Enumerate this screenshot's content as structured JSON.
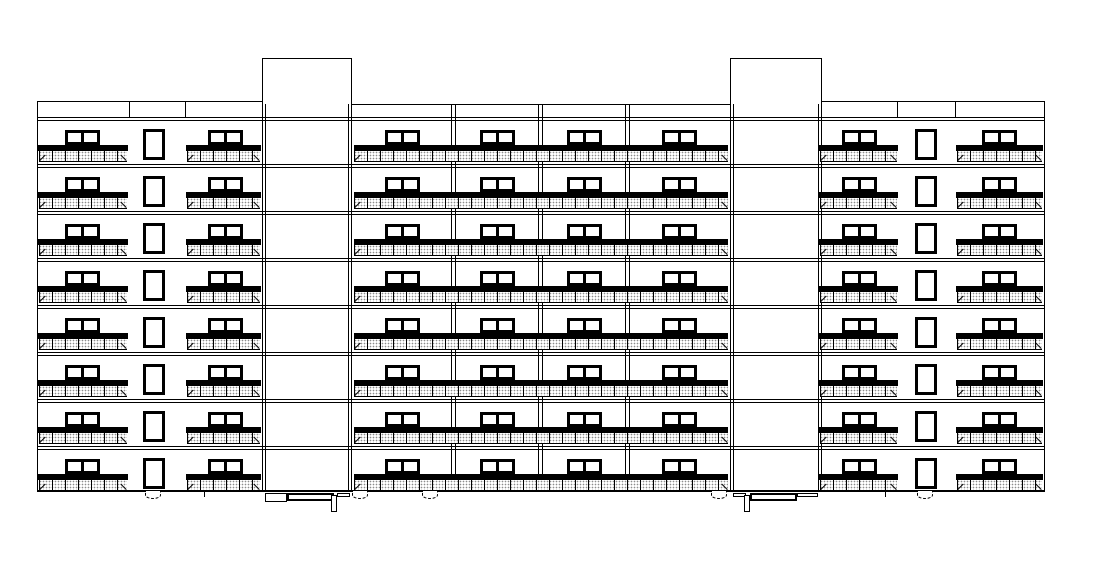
{
  "meta": {
    "title": "Residential building front elevation — 8-storey CAD line drawing",
    "colors": {
      "line": "#000000",
      "background": "#ffffff",
      "railing_stipple": "#8d8d8d"
    }
  },
  "drawing": {
    "canvas": {
      "width": 1112,
      "height": 573
    },
    "building": {
      "x1": 37,
      "x2": 1045,
      "top": 101,
      "ground_y": 491
    },
    "towers": [
      {
        "x1": 262,
        "x2": 352,
        "top": 58
      },
      {
        "x1": 730,
        "x2": 822,
        "top": 58
      }
    ],
    "parapets": [
      {
        "x1": 37,
        "x2": 262,
        "top": 101,
        "bottom": 117,
        "dividers": [
          129,
          185
        ]
      },
      {
        "x1": 822,
        "x2": 1045,
        "top": 101,
        "bottom": 117,
        "dividers": [
          897,
          955
        ]
      }
    ],
    "mid_roof_line": {
      "x1": 352,
      "x2": 730,
      "y": 104
    },
    "bay_separators": {
      "x": [
        453,
        540,
        627
      ],
      "top": 105,
      "bottom": 491,
      "gap": 4
    },
    "floors": {
      "count": 8,
      "first_band_y": 117,
      "pitch": 47,
      "band_gap": 3,
      "window": {
        "top_offset": 13,
        "height": 15,
        "frame": 3
      },
      "stair_window": {
        "top_offset": 12,
        "height": 31,
        "frame": 3
      },
      "slab": {
        "offset": 28,
        "height": 6
      },
      "railing": {
        "offset": 34,
        "height": 11,
        "post_spacing": 13
      }
    },
    "balconies": [
      {
        "id": "left-a",
        "slab": [
          38,
          128
        ],
        "rail": [
          39,
          127
        ],
        "windows": [
          [
            65,
            100
          ]
        ]
      },
      {
        "id": "left-b",
        "slab": [
          186,
          261
        ],
        "rail": [
          187,
          260
        ],
        "windows": [
          [
            208,
            243
          ]
        ]
      },
      {
        "id": "middle",
        "slab": [
          354,
          728
        ],
        "rail": [
          354,
          728
        ],
        "windows": [
          [
            385,
            420
          ],
          [
            480,
            515
          ],
          [
            567,
            602
          ],
          [
            662,
            697
          ]
        ]
      },
      {
        "id": "right-c",
        "slab": [
          819,
          898
        ],
        "rail": [
          820,
          897
        ],
        "windows": [
          [
            842,
            877
          ]
        ]
      },
      {
        "id": "right-d",
        "slab": [
          956,
          1043
        ],
        "rail": [
          957,
          1042
        ],
        "windows": [
          [
            982,
            1017
          ]
        ]
      }
    ],
    "stair_windows": [
      [
        143,
        165
      ],
      [
        915,
        937
      ]
    ],
    "ground_line": {
      "x1": 37,
      "x2": 1045,
      "y": 490,
      "thickness": 2
    },
    "entrances": [
      {
        "side": "left",
        "parts": [
          {
            "type": "box",
            "x": 265,
            "y": 493,
            "w": 22,
            "h": 9
          },
          {
            "type": "slab",
            "x": 287,
            "y": 493,
            "w": 47,
            "h": 8
          },
          {
            "type": "post",
            "x": 331,
            "y": 495,
            "w": 6,
            "h": 17
          },
          {
            "type": "box",
            "x": 337,
            "y": 493,
            "w": 13,
            "h": 4
          }
        ]
      },
      {
        "side": "right",
        "parts": [
          {
            "type": "box",
            "x": 733,
            "y": 493,
            "w": 13,
            "h": 4
          },
          {
            "type": "post",
            "x": 744,
            "y": 495,
            "w": 6,
            "h": 17
          },
          {
            "type": "slab",
            "x": 750,
            "y": 493,
            "w": 47,
            "h": 8
          },
          {
            "type": "box",
            "x": 797,
            "y": 493,
            "w": 21,
            "h": 4
          }
        ]
      }
    ],
    "foundation_vents": {
      "centers": [
        153,
        360,
        430,
        719,
        925
      ],
      "width": 16,
      "height": 8,
      "y": 491
    },
    "foundation_ticks": {
      "x": [
        204,
        885
      ],
      "y": 491,
      "height": 6
    }
  }
}
